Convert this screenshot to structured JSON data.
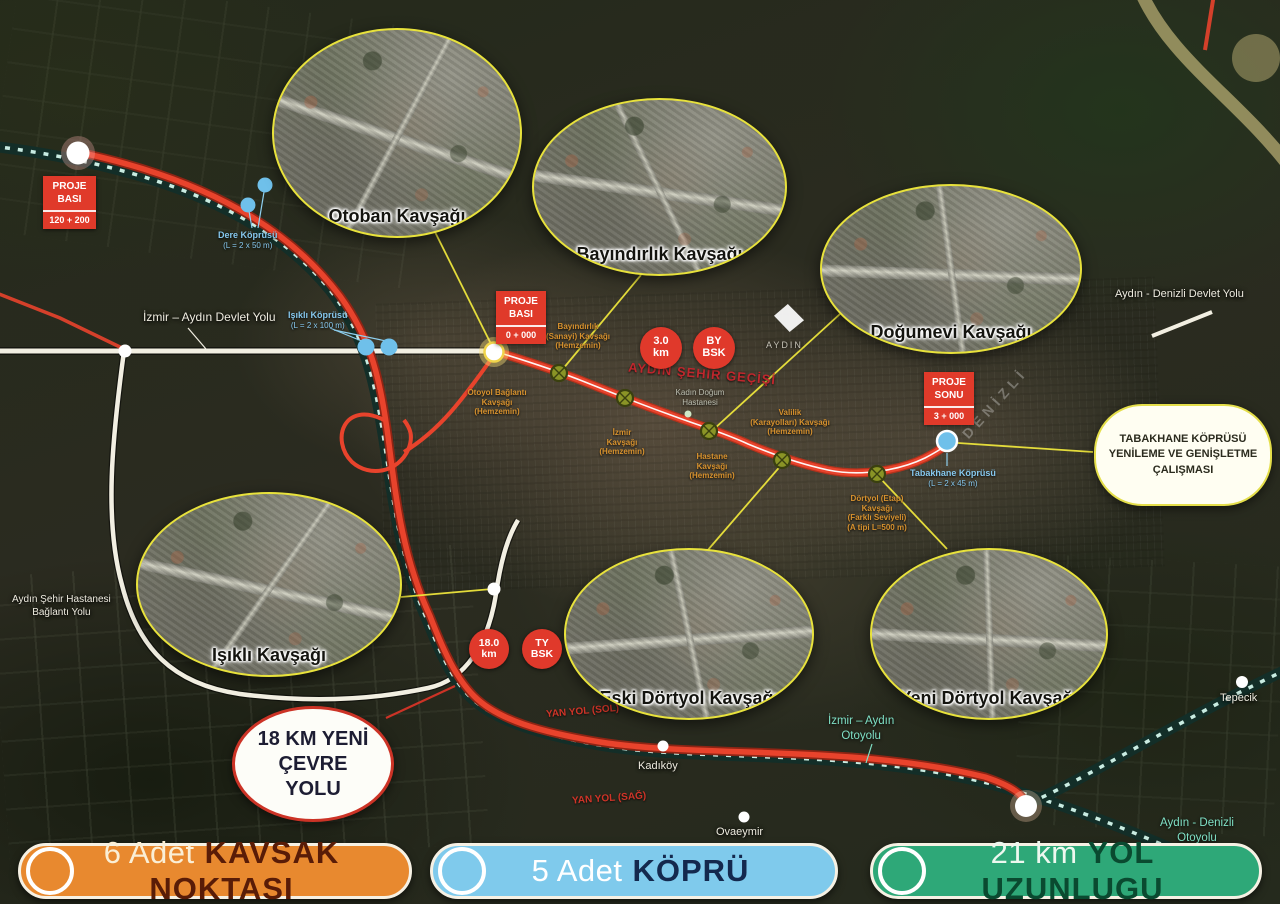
{
  "legend": {
    "items": [
      {
        "count": "6 Adet",
        "title": "KAVSAK NOKTASI",
        "fill": "#E8892F",
        "title_color": "#591C07",
        "count_color": "#FAEFD6"
      },
      {
        "count": "5 Adet",
        "title": "KÖPRÜ",
        "fill": "#7FCAEC",
        "title_color": "#14294E",
        "count_color": "#FFFFFF"
      },
      {
        "count": "21 km",
        "title": "YOL UZUNLUGU",
        "fill": "#2EA878",
        "title_color": "#0A4A30",
        "count_color": "#EDF8EF"
      }
    ]
  },
  "callouts": {
    "otoban": "Otoban Kavşağı",
    "bayindirlik": "Bayındırlık Kavşağı",
    "dogumevi": "Doğumevi Kavşağı",
    "isikli": "Işıklı Kavşağı",
    "eski_dortyol": "Eski Dörtyol Kavşağı",
    "yeni_dortyol": "Yeni Dörtyol Kavşağı"
  },
  "markers": {
    "proje_basi_1": {
      "l1": "PROJE",
      "l2": "BASI",
      "value": "120 + 200"
    },
    "proje_basi_2": {
      "l1": "PROJE",
      "l2": "BASI",
      "value": "0 + 000"
    },
    "proje_sonu": {
      "l1": "PROJE",
      "l2": "SONU",
      "value": "3 + 000"
    },
    "badge_3km": {
      "l1": "3.0",
      "l2": "km"
    },
    "badge_bybsk": {
      "l1": "BY",
      "l2": "BSK"
    },
    "badge_18km": {
      "l1": "18.0",
      "l2": "km"
    },
    "badge_tybsk": {
      "l1": "TY",
      "l2": "BSK"
    }
  },
  "notes": {
    "cevre_yolu": [
      "18 KM YENİ",
      "ÇEVRE",
      "YOLU"
    ],
    "tabakhane_box": [
      "TABAKHANE KÖPRÜSÜ",
      "YENİLEME VE GENİŞLETME",
      "ÇALIŞMASI"
    ]
  },
  "bridges": {
    "dere": [
      "Dere Köprüsü",
      "(L = 2 x 50 m)"
    ],
    "isikli": [
      "Işıklı Köprüsü",
      "(L = 2 x 100 m)"
    ],
    "tabakhane": [
      "Tabakhane Köprüsü",
      "(L = 2 x 45 m)"
    ]
  },
  "roads": {
    "izmir_aydin_devlet": "İzmir – Aydın Devlet Yolu",
    "aydin_denizli_devlet": "Aydın - Denizli Devlet Yolu",
    "hastane_baglanti": [
      "Aydın Şehir Hastanesi",
      "Bağlantı Yolu"
    ],
    "izmir_aydin_otoyol": [
      "İzmir – Aydın",
      "Otoyolu"
    ],
    "aydin_denizli_otoyol": [
      "Aydın - Denizli",
      "Otoyolu"
    ],
    "sehir_gecisi": "AYDIN ŞEHİR GEÇİŞİ",
    "yan_yol_sol": "YAN YOL (SOL)",
    "yan_yol_sag": "YAN YOL (SAĞ)",
    "denizli_watermark": "DENİZLİ"
  },
  "places": {
    "aydin": "AYDIN",
    "kadikoy": "Kadıköy",
    "ovaeymir": "Ovaeymir",
    "tepecik": "Tepecik"
  },
  "junction_labels": {
    "bayindirlik_sanayi": [
      "Bayındırlık",
      "(Sanayi) Kavşağı",
      "(Hemzemin)"
    ],
    "otoyol_baglanti": [
      "Otoyol Bağlantı",
      "Kavşağı",
      "(Hemzemin)"
    ],
    "izmir": [
      "İzmir",
      "Kavşağı",
      "(Hemzemin)"
    ],
    "hastane": [
      "Hastane",
      "Kavşağı",
      "(Hemzemin)"
    ],
    "valilik": [
      "Valilik",
      "(Karayolları) Kavşağı",
      "(Hemzemin)"
    ],
    "dortyol_etap": [
      "Dörtyol (Etap)",
      "Kavşağı",
      "(Farklı Seviyeli)",
      "(A tipi L=500 m)"
    ],
    "kadin_dogum": [
      "Kadın Doğum",
      "Hastanesi"
    ]
  },
  "colors": {
    "route_red": "#E8432C",
    "motorway_dash": "#C9ECE2",
    "connector_yellow": "#EDE53C",
    "bridge_blue": "#6FC0EA"
  }
}
